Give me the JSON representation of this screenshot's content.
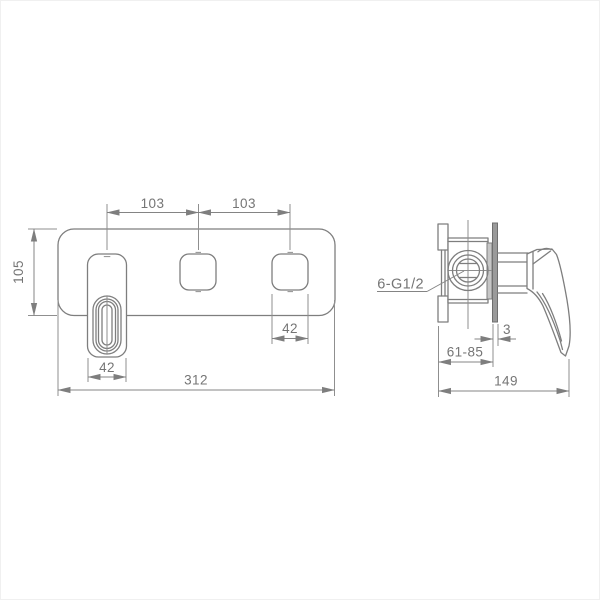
{
  "drawing": {
    "type": "technical-drawing",
    "subject": "wall-mounted-mixer-faucet",
    "units": "mm",
    "front_view": {
      "dimensions": {
        "spacing_left": "103",
        "spacing_right": "103",
        "plate_height": "105",
        "handle_cutout_width": "42",
        "outlet_cutout_width": "42",
        "plate_width": "312"
      }
    },
    "side_view": {
      "labels": {
        "thread": "6-G1/2"
      },
      "dimensions": {
        "plate_thickness": "3",
        "installation_depth": "61-85",
        "overall_depth": "149"
      }
    },
    "colors": {
      "background": "#ffffff",
      "outline": "#7e7e7e",
      "dimension_line": "#848484",
      "text": "#757575",
      "section_fill": "#9a9a9a"
    }
  }
}
